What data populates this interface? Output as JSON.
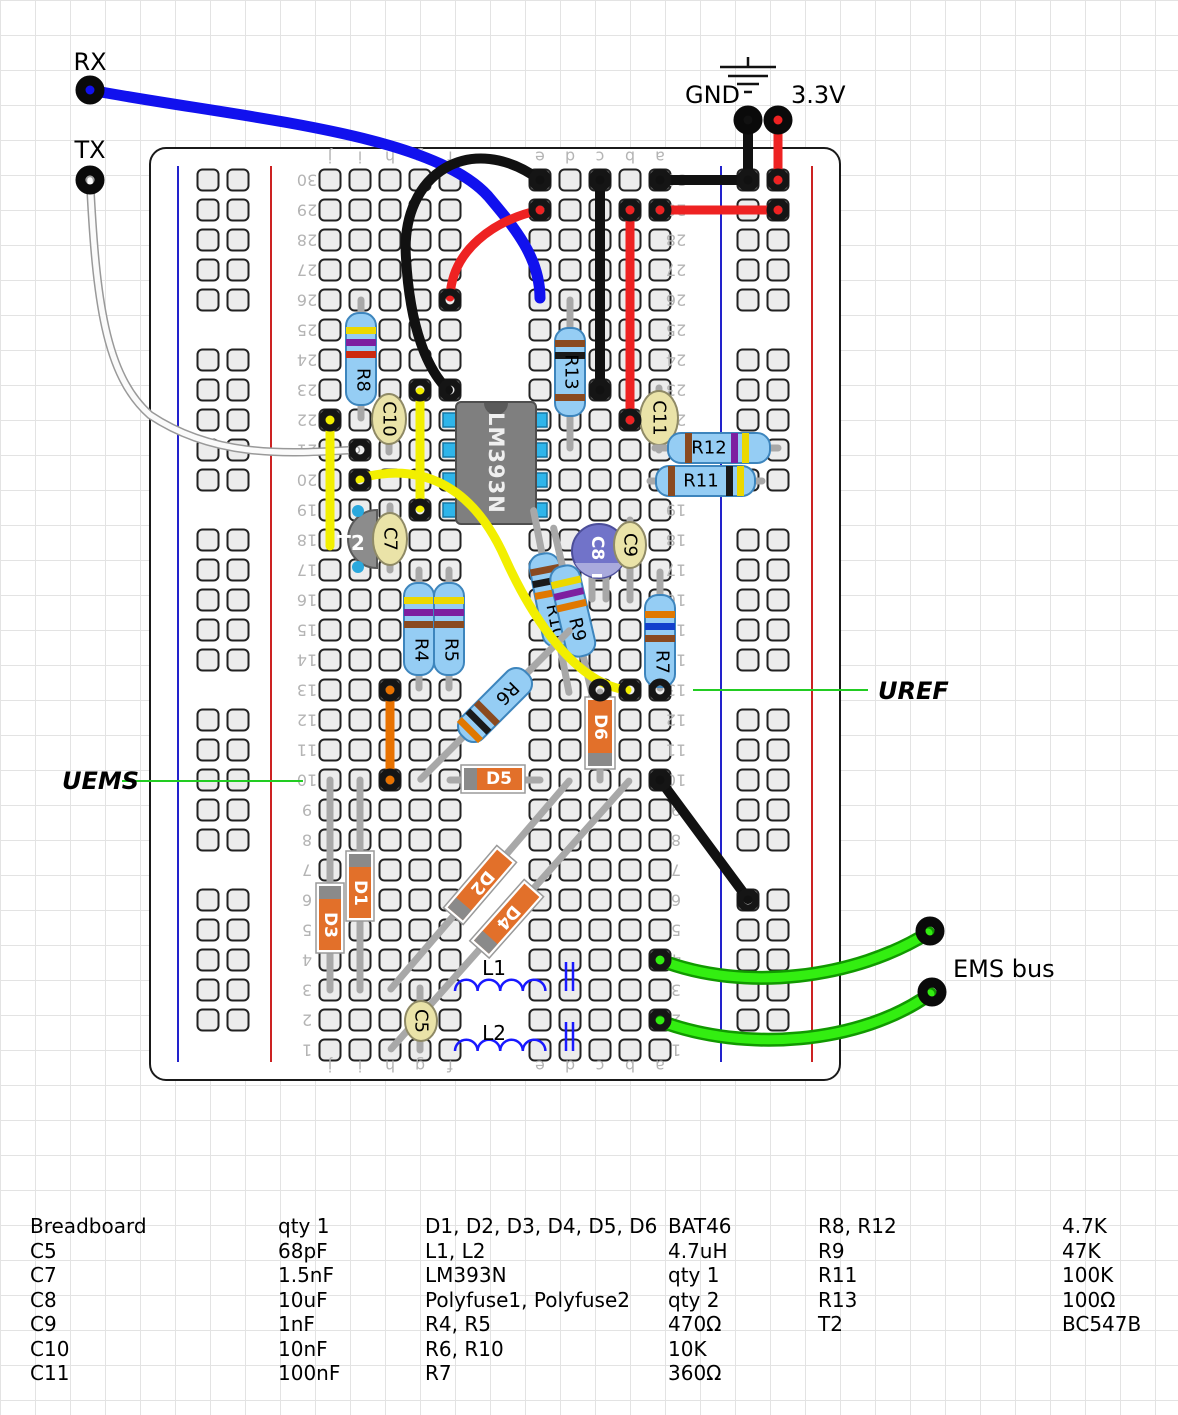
{
  "annotations": {
    "rx": "RX",
    "tx": "TX",
    "gnd": "GND",
    "v33": "3.3V",
    "ems_bus": "EMS bus",
    "uems": "UEMS",
    "uref": "UREF"
  },
  "board": {
    "column_letters": [
      "j",
      "i",
      "h",
      "g",
      "f",
      "e",
      "d",
      "c",
      "b",
      "a"
    ],
    "row_count": 30
  },
  "components": {
    "r4": "R4",
    "r5": "R5",
    "r6": "R6",
    "r7": "R7",
    "r8": "R8",
    "r9": "R9",
    "r10": "R10",
    "r11": "R11",
    "r12": "R12",
    "r13": "R13",
    "c5": "C5",
    "c7": "C7",
    "c8": "C8",
    "c9": "C9",
    "c10": "C10",
    "c11": "C11",
    "c8_minus": "-",
    "d1": "D1",
    "d2": "D2",
    "d3": "D3",
    "d4": "D4",
    "d5": "D5",
    "d6": "D6",
    "l1": "L1",
    "l2": "L2",
    "t2": "T2",
    "ic": "LM393N"
  },
  "palette": {
    "wire_blue": "#1111ee",
    "wire_red": "#ee2222",
    "wire_black": "#111111",
    "wire_yellow": "#f2ef00",
    "wire_orange": "#e87200",
    "wire_green": "#33ee11",
    "wire_white": "#fafafa",
    "callout_green": "#22cc22",
    "resistor_body": "#95cdf4",
    "diode_body": "#e2702a",
    "cap_tan": "#eae3a8",
    "cap_electrolytic": "#7173c9",
    "ic_gray": "#7f7f7f",
    "board_rail_blue": "#2222cc",
    "board_rail_red": "#cc2222"
  },
  "parts_list": {
    "groups": [
      {
        "rows": [
          [
            "Breadboard",
            "qty 1"
          ],
          [
            "C5",
            "68pF"
          ],
          [
            "C7",
            "1.5nF"
          ],
          [
            "C8",
            "10uF"
          ],
          [
            "C9",
            "1nF"
          ],
          [
            "C10",
            "10nF"
          ],
          [
            "C11",
            "100nF"
          ]
        ]
      },
      {
        "rows": [
          [
            "D1, D2, D3, D4, D5, D6",
            "BAT46"
          ],
          [
            "L1, L2",
            "4.7uH"
          ],
          [
            "LM393N",
            "qty 1"
          ],
          [
            "Polyfuse1, Polyfuse2",
            "qty 2"
          ],
          [
            "R4, R5",
            "470Ω"
          ],
          [
            "R6, R10",
            "10K"
          ],
          [
            "R7",
            "360Ω"
          ]
        ]
      },
      {
        "rows": [
          [
            "R8, R12",
            "4.7K"
          ],
          [
            "R9",
            "47K"
          ],
          [
            "R11",
            "100K"
          ],
          [
            "R13",
            "100Ω"
          ],
          [
            "T2",
            "BC547B"
          ]
        ]
      }
    ]
  }
}
